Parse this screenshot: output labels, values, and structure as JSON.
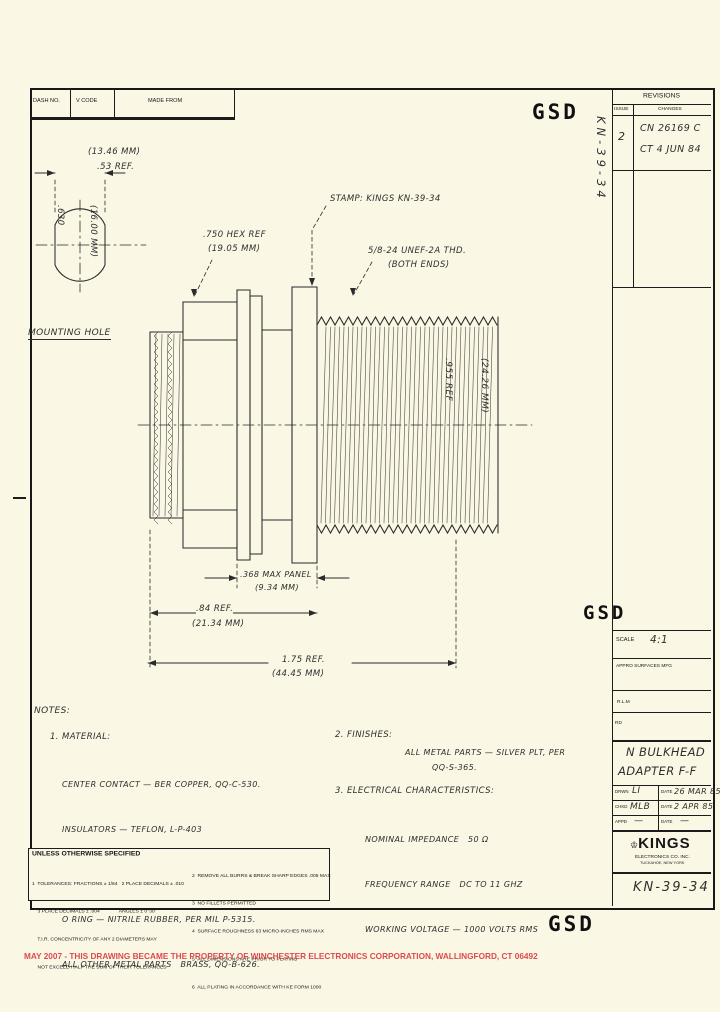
{
  "colors": {
    "paper": "#fbf7e5",
    "ink": "#1d1d1d",
    "red": "#dd4a4e"
  },
  "header": {
    "dash_no": "DASH NO.",
    "v_code": "V CODE",
    "made_from": "MADE FROM"
  },
  "revisions": {
    "title": "REVISIONS",
    "issue_header": "ISSUE",
    "changes_header": "CHANGES",
    "issue": "2",
    "change_line1": "CN 26169 C",
    "change_line2": "CT 4 JUN 84",
    "margin_note": "KN-39-34"
  },
  "stamps": {
    "gsd": "GSD"
  },
  "mounting_hole": {
    "label": "MOUNTING HOLE",
    "width_mm": "(13.46 MM)",
    "width_in": ".53 REF.",
    "dia_mm": "(16.00 MM)",
    "dia_in": ".630"
  },
  "callouts": {
    "hex_in": ".750 HEX REF",
    "hex_mm": "(19.05 MM)",
    "stamp": "STAMP: KINGS KN-39-34",
    "thread": "5/8-24 UNEF-2A THD.",
    "thread_ends": "(BOTH ENDS)",
    "len_mm": "(24.26 MM)",
    "len_in": ".955 REF"
  },
  "dimensions": {
    "panel_in": ".368 MAX PANEL",
    "panel_mm": "(9.34 MM)",
    "body_in": ".84 REF.",
    "body_mm": "(21.34 MM)",
    "overall_in": "1.75 REF.",
    "overall_mm": "(44.45 MM)"
  },
  "notes": {
    "heading": "NOTES:",
    "material_heading": "1. MATERIAL:",
    "material_lines": [
      "CENTER CONTACT — BER COPPER, QQ-C-530.",
      "INSULATORS — TEFLON, L-P-403",
      "LOCKWASHER — PHOSPHOR BRONZE, QQ-B-750.",
      "O RING — NITRILE RUBBER, PER MIL P-5315.",
      "ALL OTHER METAL PARTS   BRASS, QQ-B-626."
    ],
    "finishes_heading": "2. FINISHES:",
    "finishes_line1": "ALL METAL PARTS — SILVER PLT, PER",
    "finishes_line2": "QQ-S-365.",
    "electrical_heading": "3. ELECTRICAL CHARACTERISTICS:",
    "electrical_lines": [
      "NOMINAL IMPEDANCE   50 Ω",
      "FREQUENCY RANGE   DC TO 11 GHZ",
      "WORKING VOLTAGE — 1000 VOLTS RMS"
    ]
  },
  "spec_block": {
    "title": "UNLESS OTHERWISE SPECIFIED",
    "left_lines": [
      "1  TOLERANCES: FRACTIONS ± 1/64   2 PLACE DECIMALS ± .010",
      "    3 PLACE DECIMALS ± .004              ANGLES ± 0°30'",
      "    T.I.R. CONCENTRICITY OF ANY 2 DIAMETERS MAY",
      "    NOT EXCEED HALF THE SUM OF THEIR TOLERANCES"
    ],
    "right_lines": [
      "2  REMOVE ALL BURRS & BREAK SHARP EDGES .005 MAX",
      "3  NO FILLETS PERMITTED",
      "4  SURFACE ROUGHNESS 63 MICRO-INCHES RMS MAX",
      "5  ALL DIMENSIONS ARE PRIOR TO PLATING",
      "6  ALL PLATING IN ACCORDANCE WITH KE FORM 1000"
    ]
  },
  "title_block": {
    "scale_label": "SCALE",
    "scale_value": "4:1",
    "surfaces_label": "APPRO SURFACES MFG",
    "field_a": "R.L.M",
    "field_b": "RD",
    "title_line1": "N BULKHEAD",
    "title_line2": "ADAPTER F-F",
    "drawn_label": "DRWN",
    "drawn_value": "LI",
    "drawn_date_label": "DATE",
    "drawn_date": "26 MAR 85",
    "checked_label": "CHKD",
    "checked_value": "MLB",
    "checked_date_label": "DATE",
    "checked_date": "2 APR 85",
    "approved_label": "APPD",
    "approved_value": "—",
    "approved_date_label": "DATE",
    "approved_date": "—",
    "company": "KINGS",
    "company_sub1": "ELECTRONICS CO. INC.",
    "company_sub2": "TUCKAHOE, NEW YORK",
    "crown_icon": "♔",
    "drawing_number": "KN-39-34"
  },
  "footer": {
    "property_note": "MAY 2007 - THIS DRAWING BECAME THE PROPERTY OF WINCHESTER ELECTRONICS CORPORATION, WALLINGFORD, CT 06492"
  }
}
